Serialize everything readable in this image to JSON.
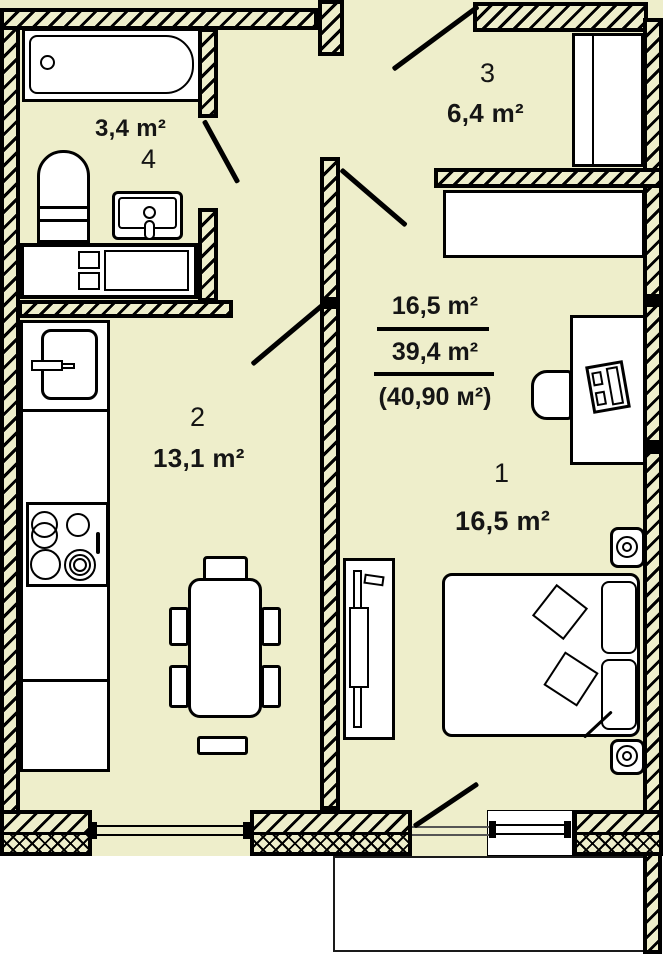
{
  "title": "Apartment floor plan",
  "summary": {
    "living_area": "16,5 m²",
    "total_area": "39,4 m²",
    "total_with_balcony": "(40,90 м²)"
  },
  "rooms": [
    {
      "number": "1",
      "name": "bedroom-living-room",
      "area": "16,5 m²"
    },
    {
      "number": "2",
      "name": "kitchen",
      "area": "13,1 m²"
    },
    {
      "number": "3",
      "name": "hallway",
      "area": "6,4 m²"
    },
    {
      "number": "4",
      "name": "bathroom",
      "area": "3,4 m²"
    }
  ],
  "colors": {
    "floor": "#eeeecb",
    "wall": "#000000",
    "furniture": "#ffffff"
  }
}
